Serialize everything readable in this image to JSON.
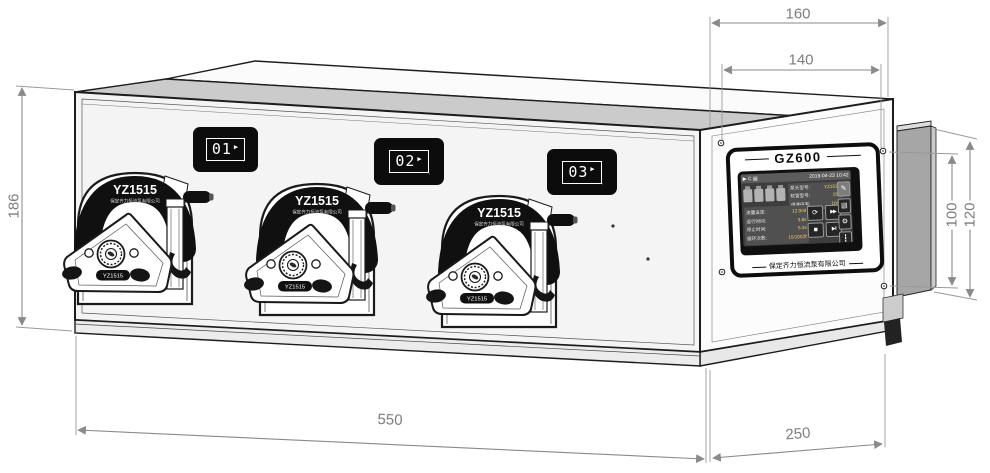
{
  "dimensions": {
    "d160": "160",
    "d140": "140",
    "d186": "186",
    "d100": "100",
    "d120": "120",
    "d550": "550",
    "d250": "250"
  },
  "pump": {
    "model": "YZ1515",
    "subtitle": "保定齐力恒流泵有限公司",
    "badge": "YZ1515"
  },
  "displays": [
    {
      "number": "01"
    },
    {
      "number": "02"
    },
    {
      "number": "03"
    }
  ],
  "display_arrow": "▶",
  "display_tick": ",",
  "panel": {
    "title": "GZ600",
    "company": "保定齐力恒流泵有限公司",
    "screen": {
      "status_left": "▶ C ▤",
      "status_right": "2019-04-23 10:42",
      "info_rows": [
        {
          "label": "泵头型号:",
          "value": "YZ1515"
        },
        {
          "label": "软管型号:",
          "value": "15#"
        },
        {
          "label": "调速倍率:",
          "value": "10%"
        }
      ],
      "param_rows": [
        {
          "label": "流量设定:",
          "value": "12.0ml"
        },
        {
          "label": "运行时间:",
          "value": "3.8s"
        },
        {
          "label": "停止时间:",
          "value": "5.3s"
        },
        {
          "label": "循环次数:",
          "value": "15/100次"
        }
      ],
      "buttons": {
        "cycle": "⟳",
        "fast": "▶▶",
        "stop": "■",
        "start": "▶‖"
      },
      "side_icons": {
        "prime": "✎",
        "list": "▤",
        "gear": "⚙",
        "tune": "┇"
      }
    }
  }
}
